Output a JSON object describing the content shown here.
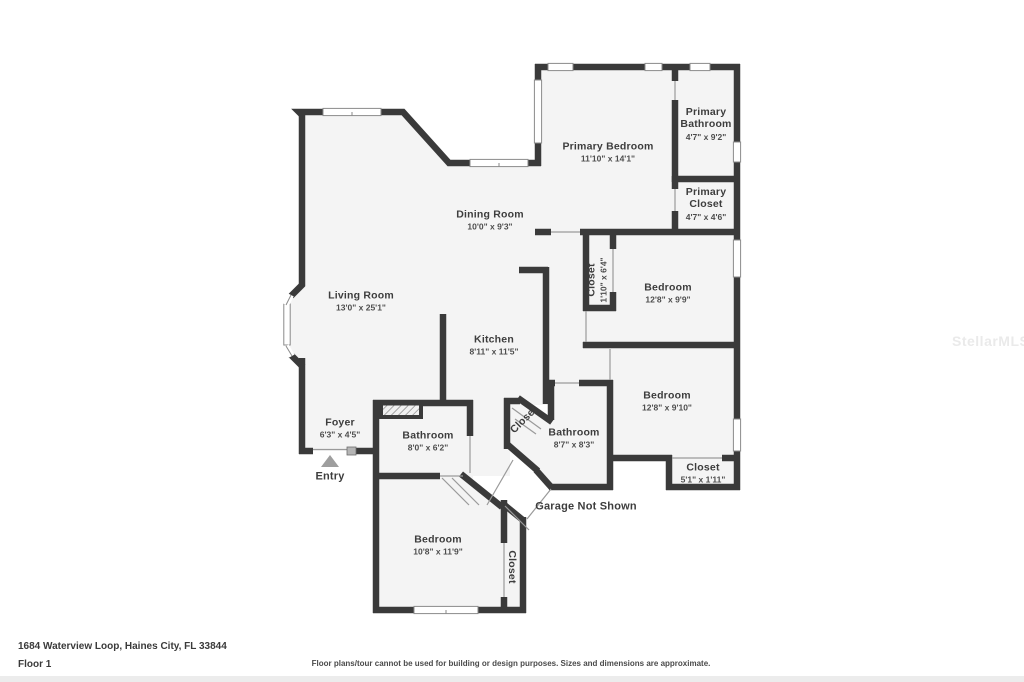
{
  "plan": {
    "rooms": {
      "living": {
        "name": "Living Room",
        "dims": "13'0\" x 25'1\""
      },
      "dining": {
        "name": "Dining Room",
        "dims": "10'0\" x 9'3\""
      },
      "kitchen": {
        "name": "Kitchen",
        "dims": "8'11\" x 11'5\""
      },
      "primary_bedroom": {
        "name": "Primary Bedroom",
        "dims": "11'10\" x 14'1\""
      },
      "primary_bathroom": {
        "name": "Primary Bathroom",
        "dims": "4'7\" x 9'2\""
      },
      "primary_closet": {
        "name": "Primary Closet",
        "dims": "4'7\" x 4'6\""
      },
      "closet_hall": {
        "name": "Closet",
        "dims": "1'10\" x 6'4\""
      },
      "bedroom_ne": {
        "name": "Bedroom",
        "dims": "12'8\" x 9'9\""
      },
      "bedroom_se": {
        "name": "Bedroom",
        "dims": "12'8\" x 9'10\""
      },
      "closet_se": {
        "name": "Closet",
        "dims": "5'1\" x 1'11\""
      },
      "foyer": {
        "name": "Foyer",
        "dims": "6'3\" x 4'5\""
      },
      "bathroom_w": {
        "name": "Bathroom",
        "dims": "8'0\" x 6'2\""
      },
      "bathroom_c": {
        "name": "Bathroom",
        "dims": "8'7\" x 8'3\""
      },
      "bedroom_sw": {
        "name": "Bedroom",
        "dims": "10'8\" x 11'9\""
      },
      "closet_diag": {
        "name": "Closet"
      },
      "closet_sw": {
        "name": "Closet"
      }
    },
    "labels": {
      "entry": "Entry",
      "garage": "Garage Not Shown"
    }
  },
  "footer": {
    "address": "1684 Waterview Loop, Haines City, FL 33844",
    "floor": "Floor 1",
    "disclaimer": "Floor plans/tour cannot be used for building or design purposes. Sizes and dimensions are approximate."
  },
  "watermark": "StellarMLS",
  "colors": {
    "wall": "#3a3a3a",
    "room_fill": "#f4f4f4",
    "window_frame": "#8a8a8a",
    "label_text": "#3d3d3d",
    "entry_arrow": "#9e9e9e"
  }
}
